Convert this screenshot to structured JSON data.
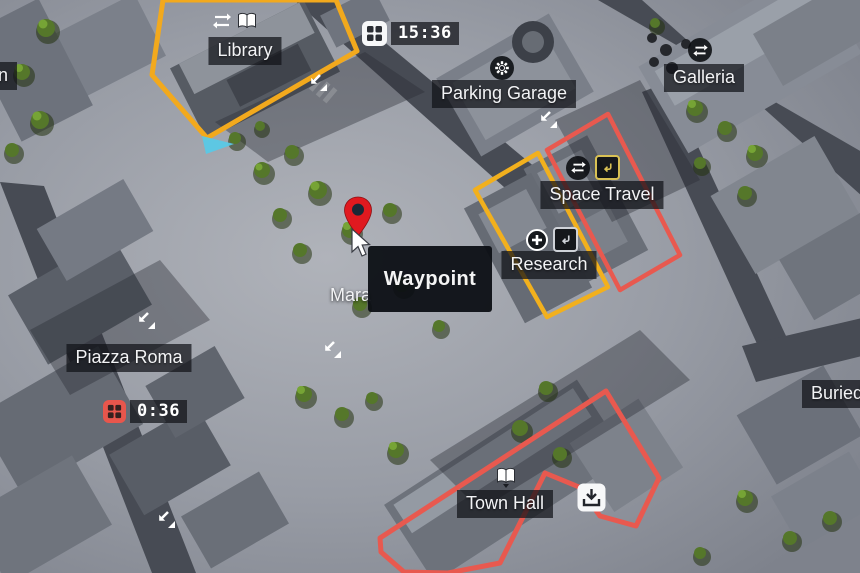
{
  "map": {
    "tooltip": {
      "label": "Waypoint"
    },
    "timers": [
      {
        "time": "15:36",
        "style": "white",
        "icon": "window-grid-icon"
      },
      {
        "time": "0:36",
        "style": "red",
        "icon": "window-grid-icon"
      }
    ],
    "locations": {
      "station_partial": {
        "label": "tion"
      },
      "library": {
        "label": "Library",
        "icons": [
          "transfer-icon",
          "book-icon"
        ]
      },
      "parking_garage": {
        "label": "Parking Garage",
        "icons": [
          "gear-icon"
        ]
      },
      "galleria": {
        "label": "Galleria",
        "icons": [
          "transfer-icon"
        ]
      },
      "space_travel": {
        "label": "Space Travel",
        "icons": [
          "transfer-icon",
          "quest-badge-icon"
        ]
      },
      "research": {
        "label": "Research",
        "icons": [
          "plus-circle-icon",
          "quest-badge-icon"
        ]
      },
      "mara_partial": {
        "label": "Mara"
      },
      "piazza_roma": {
        "label": "Piazza Roma",
        "icons": [
          "descend-arrows-icon"
        ]
      },
      "town_hall": {
        "label": "Town Hall",
        "icons": [
          "book-icon",
          "collect-box-icon"
        ]
      },
      "buried_partial": {
        "label": "Buried"
      }
    },
    "markers": {
      "waypoint_pin": "red map pin",
      "player_marker": "cyan triangle",
      "cursor": "white pointer",
      "descend_arrow_spots": 5
    },
    "colors": {
      "outline_yellow": "#f2a91d",
      "outline_red": "#e8594f",
      "timer_red": "#e8564c",
      "waypoint_red": "#e0191f",
      "player_cyan": "#5ac8e6",
      "label_bg": "rgba(16,18,24,0.72)",
      "tooltip_bg": "rgba(11,14,19,0.94)"
    }
  }
}
